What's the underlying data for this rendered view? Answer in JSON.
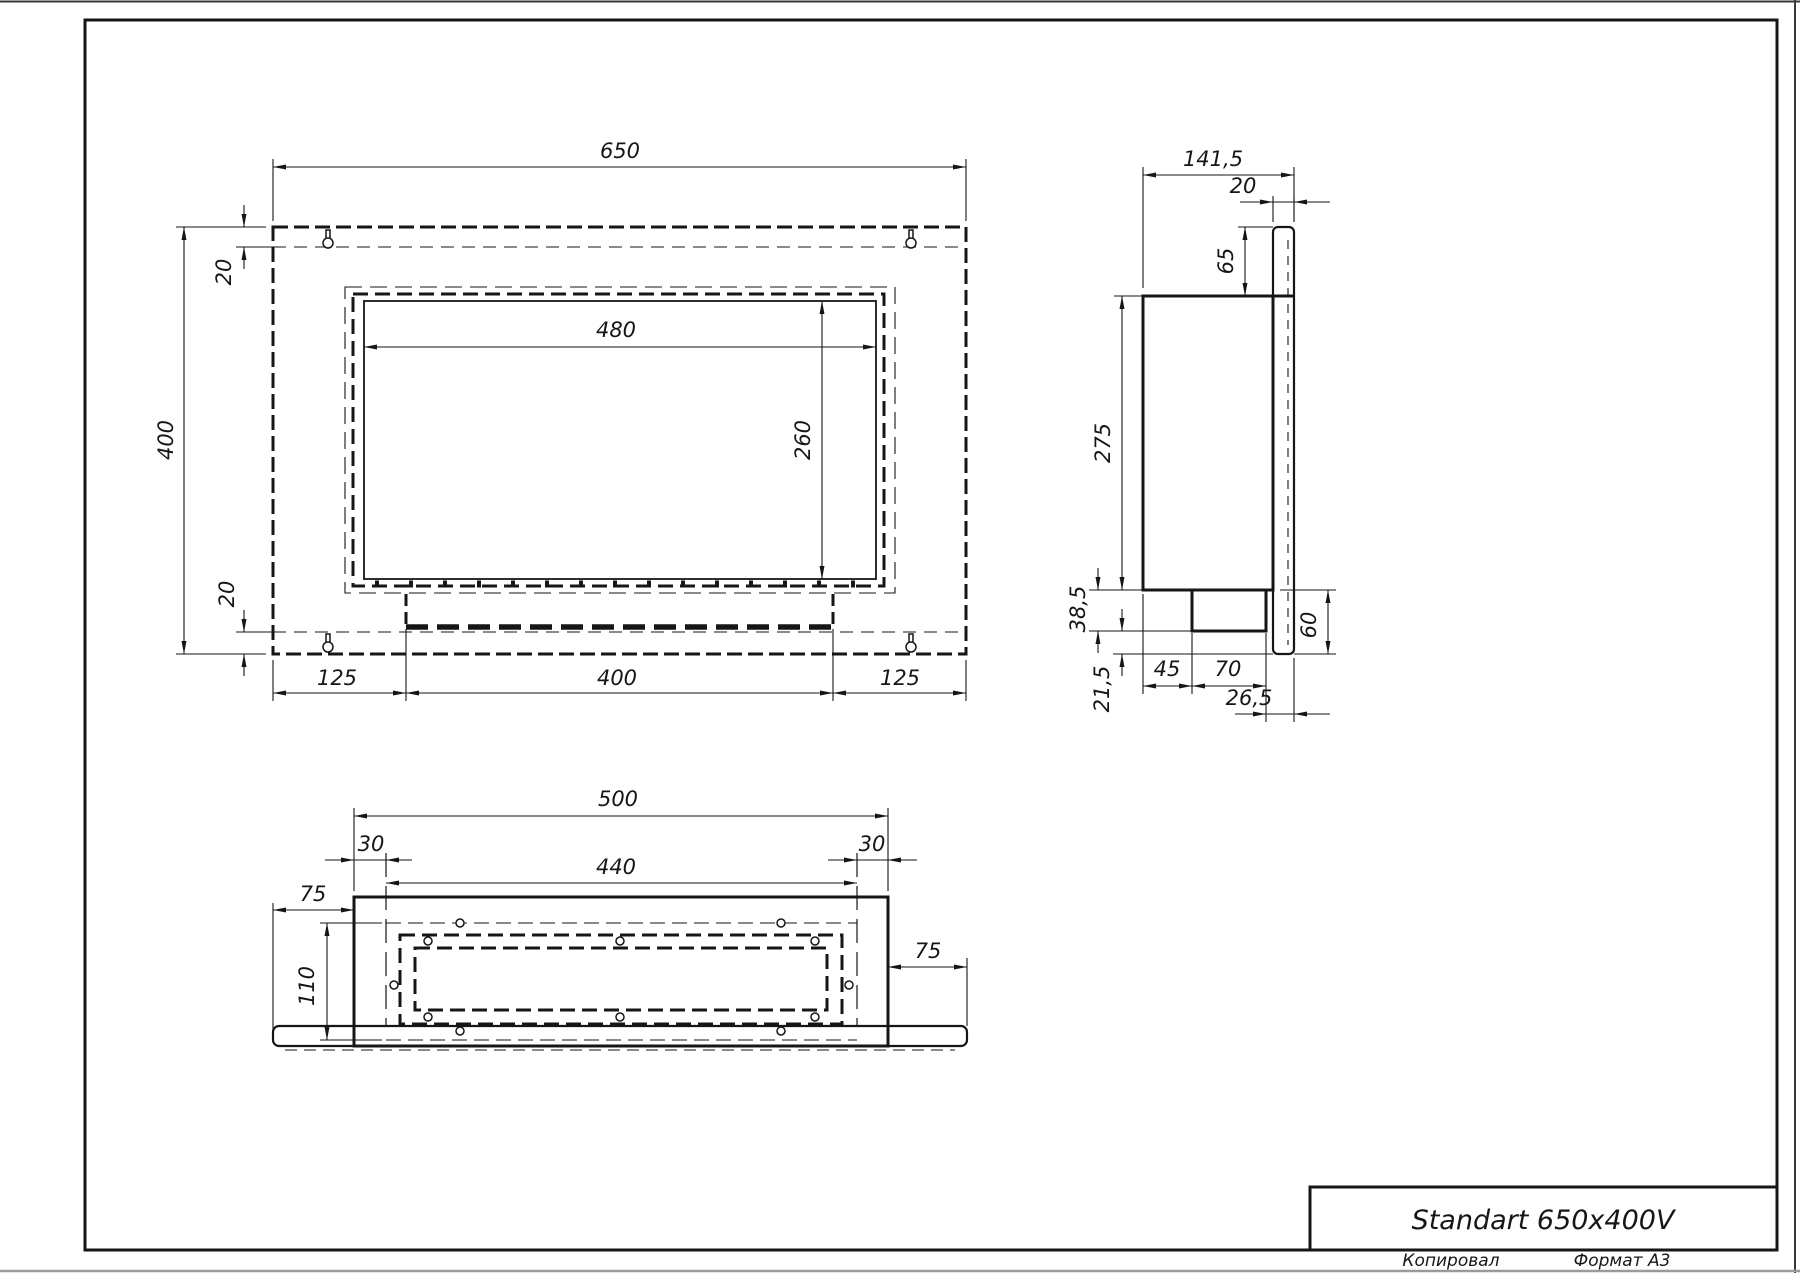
{
  "sheet": {
    "title": "Standart 650x400V",
    "footer_copy": "Копировал",
    "footer_format": "Формат А3"
  },
  "front_view": {
    "width": "650",
    "height": "400",
    "inset_top": "20",
    "inset_bottom": "20",
    "opening_width": "480",
    "opening_height": "260",
    "margin_left": "125",
    "burner_width": "400",
    "margin_right": "125"
  },
  "side_view": {
    "depth": "141,5",
    "panel_thickness": "20",
    "top_offset": "65",
    "box_height": "275",
    "burner_drop": "38,5",
    "bottom_gap": "21,5",
    "burner_setback": "45",
    "burner_depth": "70",
    "front_offset": "26,5",
    "lower_height": "60"
  },
  "bottom_view": {
    "box_width": "500",
    "inset_left": "30",
    "liner_width": "440",
    "inset_right": "30",
    "overhang_left": "75",
    "overhang_right": "75",
    "liner_depth": "110"
  }
}
